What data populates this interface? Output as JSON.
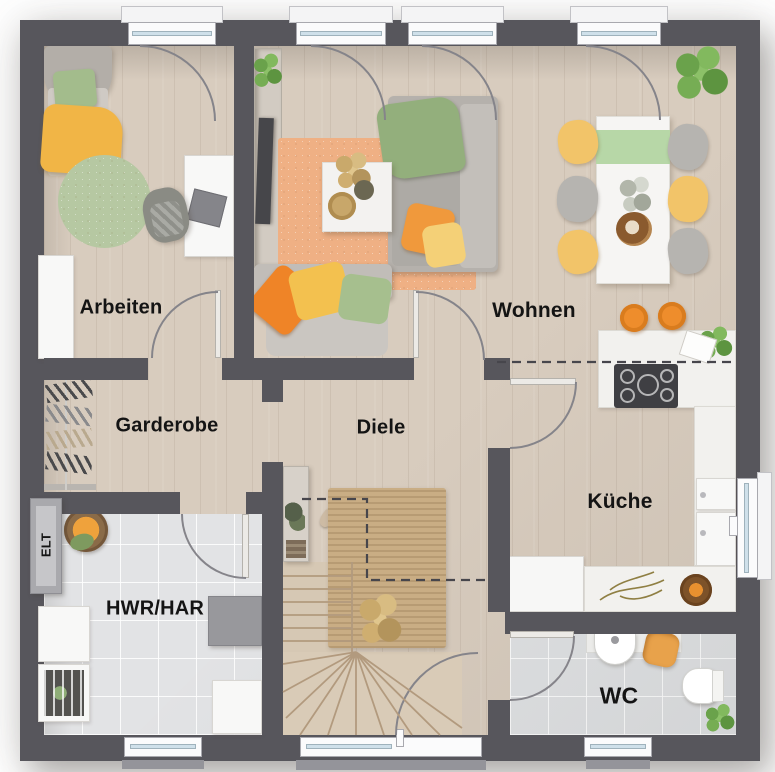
{
  "rooms": {
    "arbeiten": {
      "label": "Arbeiten"
    },
    "wohnen": {
      "label": "Wohnen"
    },
    "garderobe": {
      "label": "Garderobe"
    },
    "diele": {
      "label": "Diele"
    },
    "kueche": {
      "label": "Küche"
    },
    "hwr": {
      "label": "HWR/HAR"
    },
    "wc": {
      "label": "WC"
    },
    "elt": {
      "label": "ELT"
    }
  },
  "palette": {
    "wall": "#57565c",
    "floor_wood": "#d8ccbe",
    "floor_tile": "#e2e3e5",
    "rug_living_orange": "#efb084",
    "rug_round_green": "#b6c8a2",
    "rug_jute": "#c9ad84",
    "counter_white": "#f2f1ee",
    "glass_blue": "#cfe0ea",
    "accent_orange": "#ee8d2c",
    "accent_yellow": "#f2c469",
    "accent_green": "#9fb88a"
  }
}
